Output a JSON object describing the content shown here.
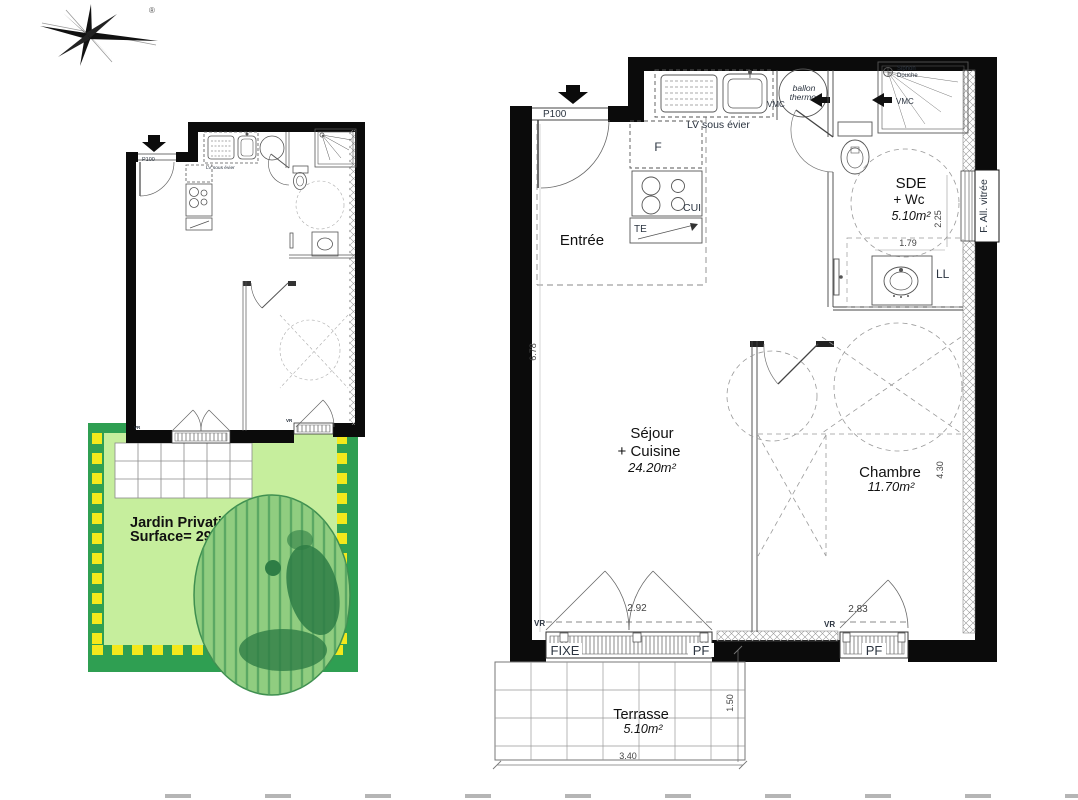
{
  "compass": {
    "reg": "®"
  },
  "garden": {
    "title": "Jardin Privatif",
    "surface": "Surface= 29.40m²"
  },
  "mini": {
    "door": "P100",
    "sink": "LV sous évier",
    "vr": "VR"
  },
  "main": {
    "door": "P100",
    "entree": "Entrée",
    "fridge": "F",
    "cui": "CUI",
    "te": "TE",
    "lv": "LV sous évier",
    "ballon1": "ballon",
    "ballon2": "thermo.",
    "vmc_left": "VMC",
    "vmc_right": "VMC",
    "siphon1": "Siphon",
    "siphon2": "Douche",
    "sde1": "SDE",
    "sde2": "+ Wc",
    "sde_area": "5.10m²",
    "ll": "LL",
    "fav": "F. All. vitrée",
    "sejour1": "Séjour",
    "sejour2": "+ Cuisine",
    "sejour_area": "24.20m²",
    "chambre": "Chambre",
    "chambre_area": "11.70m²",
    "vr_left": "VR",
    "vr_right": "VR",
    "fixe": "FIXE",
    "pf_left": "PF",
    "pf_right": "PF",
    "terrasse": "Terrasse",
    "terrasse_area": "5.10m²"
  },
  "dims": {
    "entry": "6.78",
    "sde_w": "1.79",
    "sde_h": "2.25",
    "chambre_h": "4.30",
    "sejour_win": "2.92",
    "chambre_win": "2.83",
    "terrasse_w": "3.40",
    "terrasse_d": "1.50"
  },
  "colors": {
    "wall": "#0b0b0b",
    "garden_dark": "#2f9f52",
    "garden_light": "#c6ee9d",
    "garden_boundary": "#f3e81c",
    "tree": "#90cd80",
    "tree_dark": "#2e7d45"
  }
}
